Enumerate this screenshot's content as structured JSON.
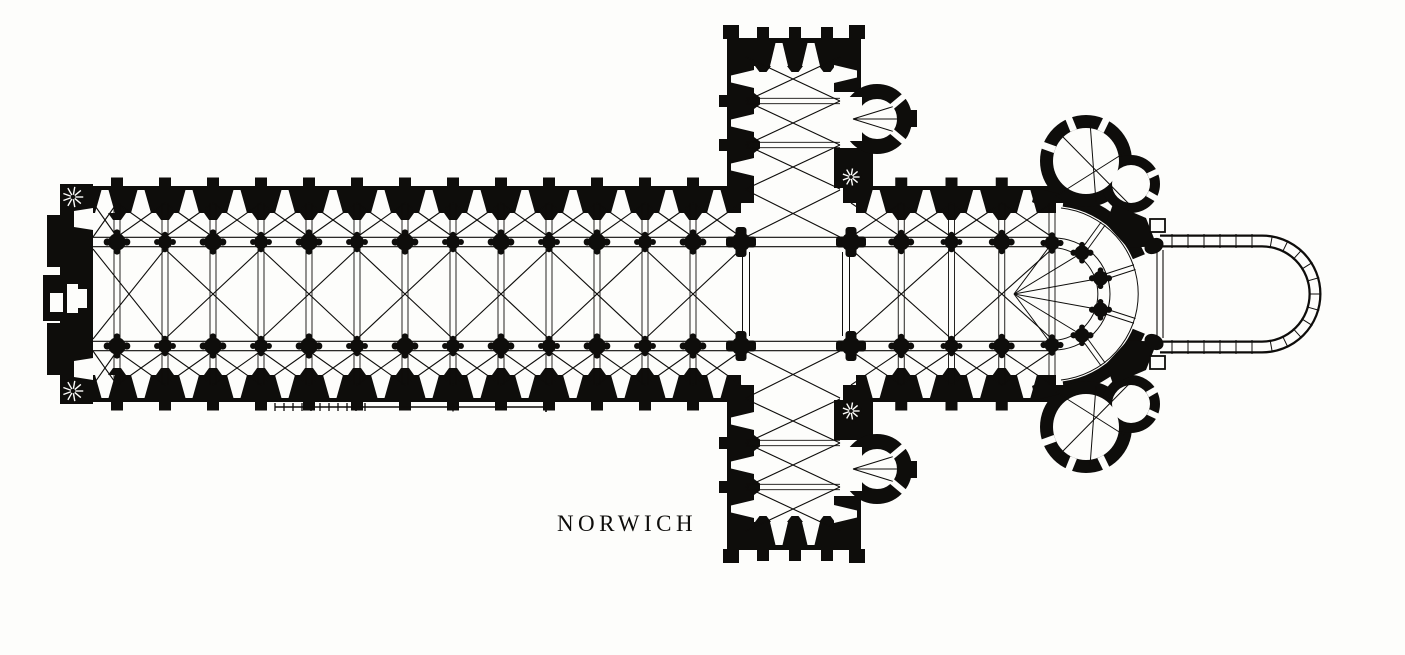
{
  "title": {
    "text": "NORWICH"
  },
  "colors": {
    "ink": "#0e0d0b",
    "paper": "#fdfdfb"
  },
  "plan": {
    "type": "cathedral-ground-plan",
    "nave": {
      "bays": 14,
      "arcade_piers_per_row": 13
    },
    "crossing": {
      "piers": 4
    },
    "transepts": {
      "arms": 2,
      "bays_per_arm": 3,
      "apsidal_chapels_per_arm": 1,
      "stair_turrets_per_arm": 1
    },
    "choir": {
      "bays": 4
    },
    "apse": {
      "hemicycle_piers": 6,
      "ambulatory": true,
      "radiating_chapels": 2,
      "axial_chapel_shown_in_outline": true
    },
    "west_front": {
      "stair_turrets": 2,
      "portals": 3
    }
  },
  "scale_bar": {
    "fine_divisions": 10,
    "long_segments": 2
  }
}
